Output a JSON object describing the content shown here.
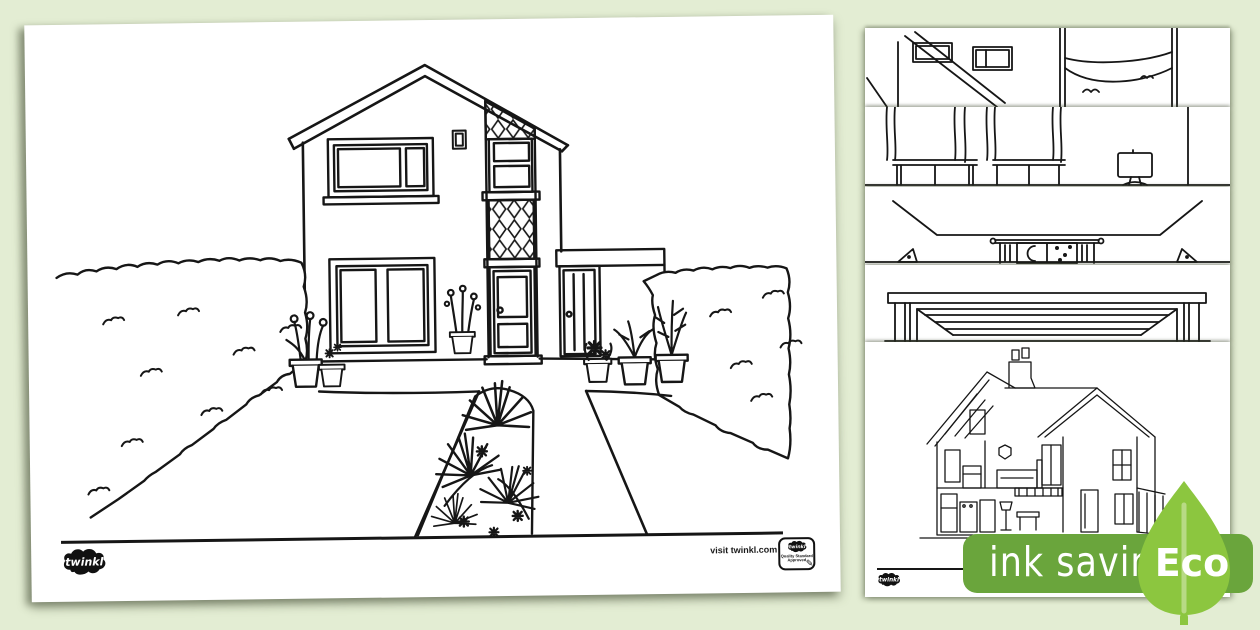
{
  "canvas": {
    "width": 1260,
    "height": 630,
    "background_color": "#e3edd3"
  },
  "artwork": {
    "line_color": "#161616",
    "paper_color": "#ffffff"
  },
  "main_page": {
    "kind": "colouring-page",
    "illustration": "two-storey house with front garden, hedges, potted plants and path",
    "footer": {
      "brand_logo_text": "twinkl",
      "visit_text": "visit twinkl.com",
      "quality_badge": {
        "logo_text": "twinkl",
        "line1": "Quality Standard",
        "line2": "Approved",
        "pencil_icon": "✎"
      }
    }
  },
  "preview_stack": {
    "pages": [
      {
        "illustration": "hallway with staircase and windows"
      },
      {
        "illustration": "room with curtained window seats and television"
      },
      {
        "illustration": "bedroom at night with moon in window"
      },
      {
        "illustration": "garage door"
      },
      {
        "illustration": "dollhouse cutaway with rooms and furniture",
        "footer_logo_text": "twinkl"
      }
    ]
  },
  "eco_badge": {
    "label": "ink saving",
    "eco_label": "Eco",
    "band_color": "#6aa53c",
    "leaf_color": "#8cc63f",
    "text_color": "#ffffff"
  }
}
